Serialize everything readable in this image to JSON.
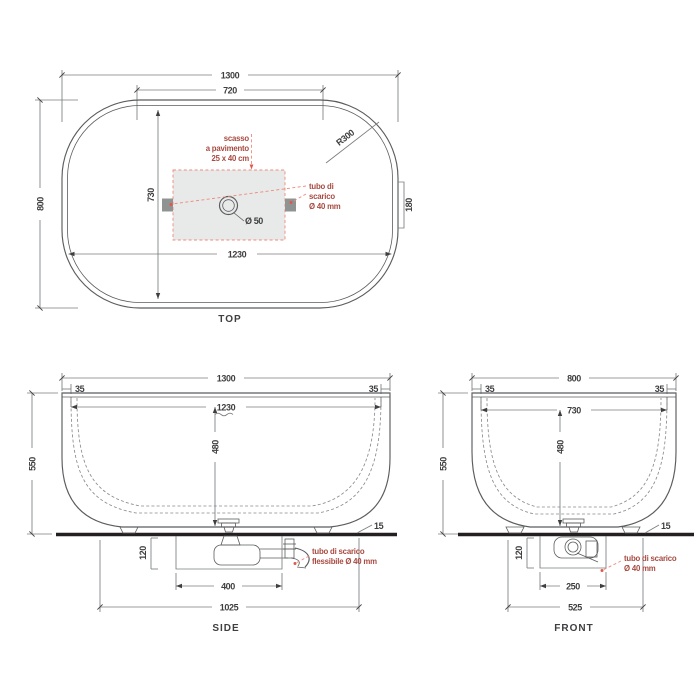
{
  "colors": {
    "line": "#5b5c5e",
    "dimension": "#3f3f41",
    "floor": "#242021",
    "annotation_red_text": "#a84a40",
    "annotation_red_dash": "#f0897d",
    "recess_fill": "#e8e9e9",
    "pipe_square_fill": "#8f9492"
  },
  "top_view": {
    "title": "TOP",
    "dim_overall_width": "1300",
    "dim_inner_top_width": "720",
    "dim_overall_depth": "800",
    "dim_inner_length": "1230",
    "dim_inner_width": "730",
    "dim_corner_radius": "R300",
    "dim_side_recess": "180",
    "drain_diameter_label": "Ø 50",
    "floor_recess_note": [
      "scasso",
      "a pavimento",
      "25 x 40 cm"
    ],
    "drain_note": [
      "tubo di",
      "scarico",
      "Ø 40 mm"
    ]
  },
  "side_view": {
    "title": "SIDE",
    "dim_overall_width": "1300",
    "dim_rim_left": "35",
    "dim_rim_right": "35",
    "dim_inner_length": "1230",
    "dim_height": "550",
    "dim_inner_depth": "480",
    "dim_recess_depth": "120",
    "dim_recess_length": "400",
    "dim_drain_span": "1025",
    "dim_base_gap": "15",
    "drain_note": [
      "tubo di scarico",
      "flessibile Ø 40 mm"
    ]
  },
  "front_view": {
    "title": "FRONT",
    "dim_overall_width": "800",
    "dim_rim_left": "35",
    "dim_rim_right": "35",
    "dim_inner_width": "730",
    "dim_height": "550",
    "dim_inner_depth": "480",
    "dim_recess_depth": "120",
    "dim_recess_length": "250",
    "dim_drain_span": "525",
    "dim_base_gap": "15",
    "drain_note": [
      "tubo di scarico",
      "Ø 40 mm"
    ]
  }
}
